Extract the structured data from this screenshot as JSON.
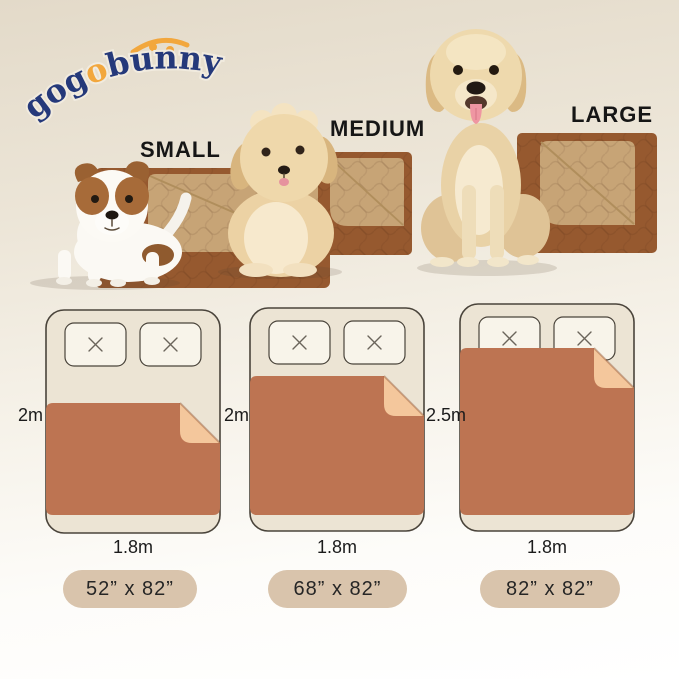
{
  "brand": {
    "name": "gogobunny",
    "name_part1": "gog",
    "name_part2": "o",
    "name_part3": "bunny"
  },
  "products": [
    {
      "size_label": "SMALL",
      "pad_dimensions": "52” x 82”",
      "bed_length": "2m",
      "bed_width": "1.8m",
      "dog": "jack-russell-puppy"
    },
    {
      "size_label": "MEDIUM",
      "pad_dimensions": "68” x 82”",
      "bed_length": "2m",
      "bed_width": "1.8m",
      "dog": "fluffy-cream-puppy"
    },
    {
      "size_label": "LARGE",
      "pad_dimensions": "82” x 82”",
      "bed_length": "2.5m",
      "bed_width": "1.8m",
      "dog": "golden-retriever"
    }
  ],
  "colors": {
    "background_top": "#e3dac9",
    "background_bottom": "#ffffff",
    "logo_navy": "#25397a",
    "logo_orange": "#f2a73d",
    "pad_brown_photo": "#96592f",
    "pad_fold_tan_photo": "#c7a476",
    "diagram_pad_brown": "#bd7452",
    "diagram_fold_peach": "#f4c79c",
    "bed_fill": "#ece4d4",
    "bed_outline": "#4a443b",
    "pillow_fill": "#f8f4ea",
    "badge_background": "#d9c4ac"
  }
}
